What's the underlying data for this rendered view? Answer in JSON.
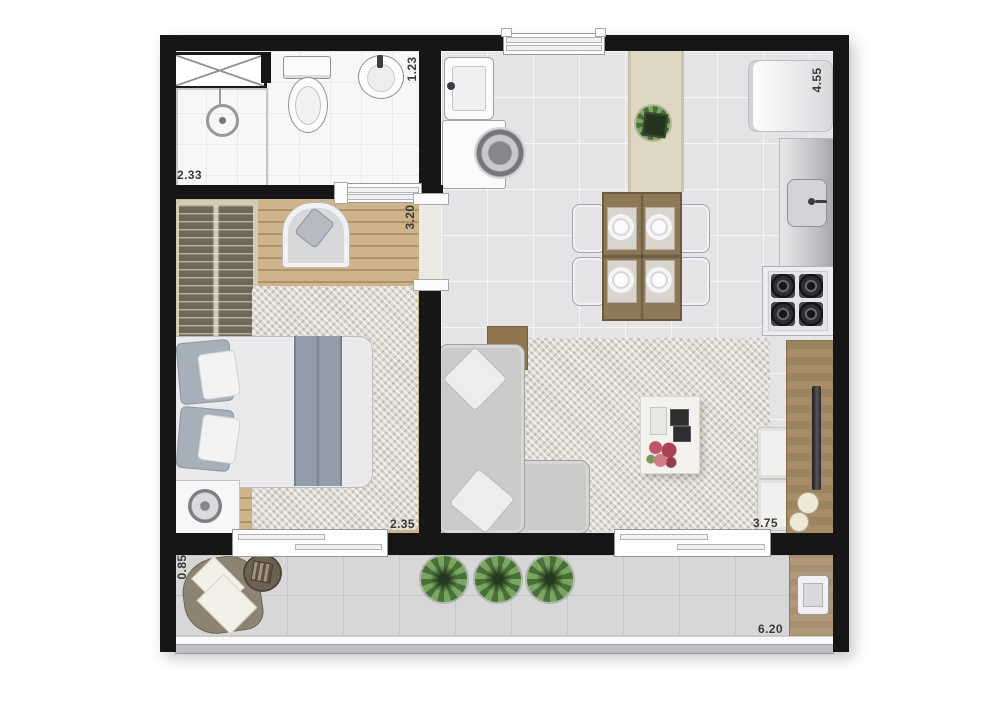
{
  "plan": {
    "type": "studio-apartment-floor-plan",
    "dimensions": {
      "bathroom_width": "2.33",
      "bathroom_depth": "1.23",
      "bedroom_depth": "3.20",
      "bedroom_width": "2.35",
      "kitchen_living_depth": "4.55",
      "living_width": "3.75",
      "balcony_depth": "0.85",
      "balcony_width": "6.20"
    },
    "palette": {
      "wall": "#161616",
      "wood_floor": "#cfb38a",
      "furniture_wood": "#8d7858",
      "tile": "#e4e4e6",
      "balcony_tile": "#d7d7d9",
      "rug": "#ddd9d0",
      "plant_green": "#5d8a41",
      "flower_red": "#b24a58",
      "label_text": "#3d3a32"
    },
    "furniture_icons": {
      "bathroom": [
        "shower-box",
        "shower",
        "toilet",
        "washbasin"
      ],
      "bedroom": [
        "wardrobe",
        "arched-nook-chair",
        "double-bed",
        "nightstand",
        "lamp",
        "area-rug"
      ],
      "kitchen": [
        "laundry-sink",
        "washing-machine",
        "runner-rug",
        "potted-plant",
        "dining-table",
        "dining-chairs",
        "refrigerator",
        "counter-sink",
        "stove"
      ],
      "living": [
        "corner-sofa",
        "sofa-side-table",
        "throw-pillows",
        "area-rug",
        "coffee-table",
        "tv-sideboard",
        "tv",
        "poufs"
      ],
      "balcony": [
        "armchair",
        "round-side-table",
        "plants",
        "grill-counter"
      ]
    }
  }
}
